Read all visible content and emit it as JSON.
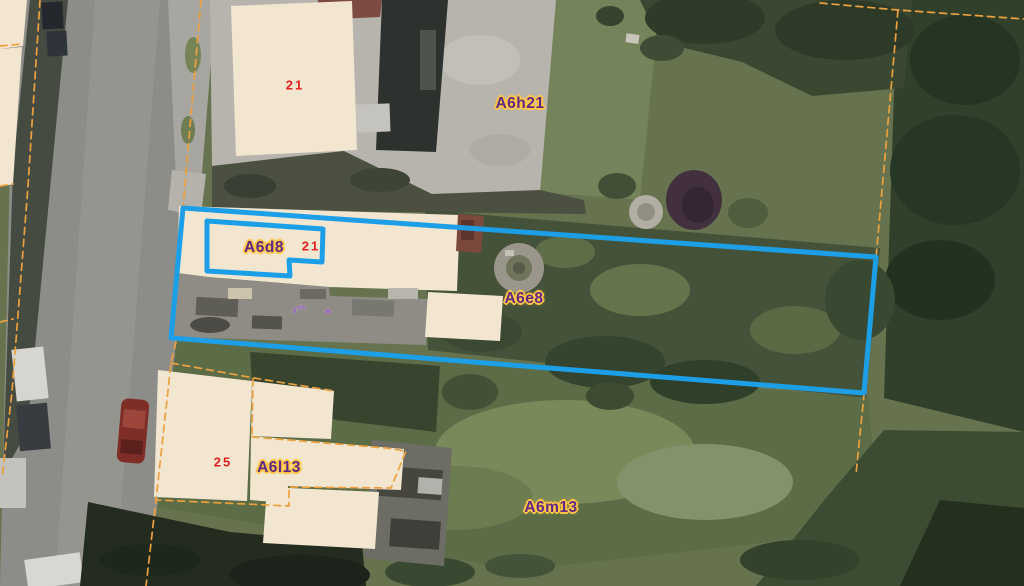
{
  "colors": {
    "selection_blue": "#1d9fe8",
    "boundary_orange": "#eda13e",
    "parcel_label_purple": "#5c2a86",
    "label_halo_yellow": "#ffc646",
    "house_number_red": "#e31e1e",
    "building_beige": "#f2e6d0",
    "marker_purple": "#9a5ec0"
  },
  "map": {
    "parcel_labels": [
      {
        "id": "A6h21",
        "text": "A6h21"
      },
      {
        "id": "A6d8",
        "text": "A6d8"
      },
      {
        "id": "A6e8",
        "text": "A6e8"
      },
      {
        "id": "A6l13",
        "text": "A6l13"
      },
      {
        "id": "A6m13",
        "text": "A6m13"
      }
    ],
    "house_numbers": [
      {
        "text": "21"
      },
      {
        "text": "21"
      },
      {
        "text": "25"
      }
    ],
    "point_markers": [
      {
        "text": "x",
        "sup": "qm"
      },
      {
        "text": "ж",
        "sup": ""
      }
    ]
  }
}
